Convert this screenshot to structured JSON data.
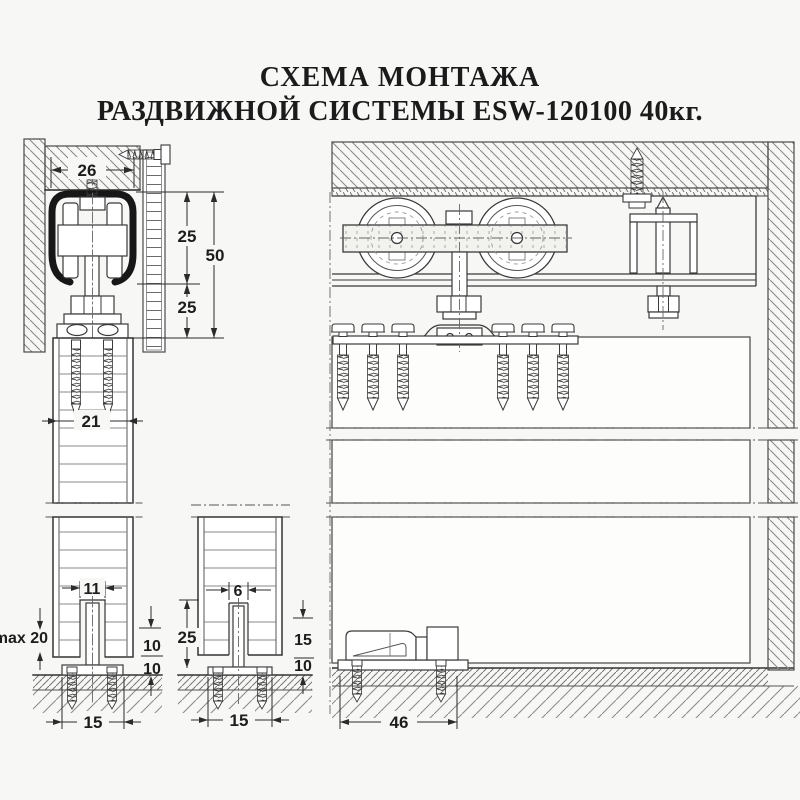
{
  "title": {
    "line1": "СХЕМА МОНТАЖА",
    "line2": "РАЗДВИЖНОЙ СИСТЕМЫ ESW-120100 40кг."
  },
  "dimensions": {
    "track_width": "26",
    "track_to_rail": "25",
    "track_to_door": "50",
    "rail_to_door": "25",
    "clamp_inner_width": "21",
    "groove_width": "11",
    "floor_max_gap": "max 20",
    "blade_height": "10",
    "base_height": "10",
    "base_width": "15",
    "glass_groove_width": "6",
    "glass_engagement": "25",
    "glass_blade_height": "15",
    "glass_base_height": "10",
    "glass_base_width": "15",
    "floor_guide_length": "46"
  }
}
